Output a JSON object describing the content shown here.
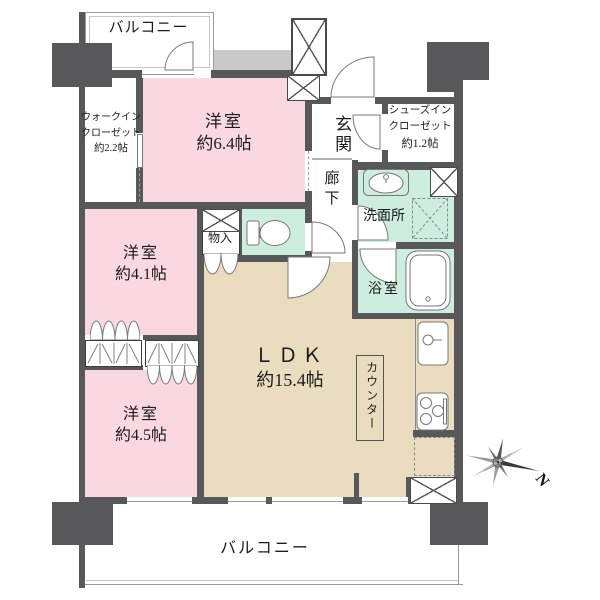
{
  "floorplan": {
    "balcony_top_label": "バルコニー",
    "balcony_bottom_label": "バルコニー",
    "rooms": {
      "bedroom64": {
        "name": "洋室",
        "area": "約6.4帖"
      },
      "wic": {
        "line1": "ウォークイン",
        "line2": "クローゼット",
        "line3": "約2.2帖"
      },
      "entrance": {
        "name": "玄関"
      },
      "sic": {
        "line1": "シューズイン",
        "line2": "クローゼット",
        "line3": "約1.2帖"
      },
      "hallway": {
        "name": "廊下"
      },
      "washroom": {
        "name": "洗面所"
      },
      "bathroom": {
        "name": "浴室"
      },
      "storage": {
        "name": "物入"
      },
      "bedroom41": {
        "name": "洋室",
        "area": "約4.1帖"
      },
      "ldk": {
        "name": "ＬＤＫ",
        "area": "約15.4帖"
      },
      "counter": {
        "name": "カウンター"
      },
      "bedroom45": {
        "name": "洋室",
        "area": "約4.5帖"
      }
    },
    "compass": {
      "north": "N"
    },
    "colors": {
      "wall": "#58585b",
      "bedroom_pink": "#f9d8e2",
      "wet_area_mint": "#cdeede",
      "ldk_beige": "#e9dcbf",
      "common_gray": "#c9c9c9"
    }
  }
}
